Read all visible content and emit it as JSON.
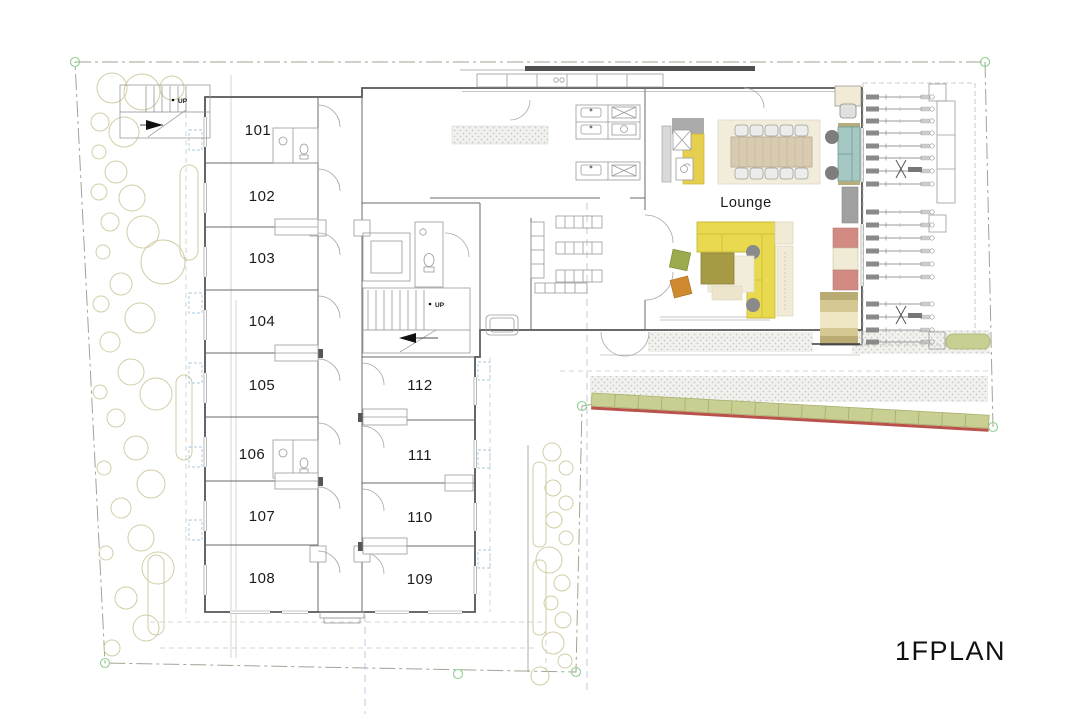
{
  "drawing": {
    "title": "1FPLAN",
    "lounge_label": "Lounge",
    "up_label": "UP",
    "rooms": [
      {
        "number": "101"
      },
      {
        "number": "102"
      },
      {
        "number": "103"
      },
      {
        "number": "104"
      },
      {
        "number": "105"
      },
      {
        "number": "106"
      },
      {
        "number": "107"
      },
      {
        "number": "108"
      },
      {
        "number": "109"
      },
      {
        "number": "110"
      },
      {
        "number": "111"
      },
      {
        "number": "112"
      }
    ]
  },
  "colors": {
    "sofa_yellow": "#e8d94e",
    "counter_yellow": "#e6cf4f",
    "sofa_teal": "#a5c8c3",
    "shelf_red": "#d28b82",
    "shelf_cream": "#f1ebd5",
    "table_tan": "#d8cbb2",
    "rug_cream": "#f2ecda",
    "table_olive": "#a79a45",
    "cushion_green": "#9cab4d",
    "cushion_orange": "#cf8a30",
    "hedge_green": "#c9cf93",
    "boundary_red": "#b8524b",
    "side_table_gray": "#8a8a8a",
    "canopy_dark": "#4f4f4f"
  }
}
